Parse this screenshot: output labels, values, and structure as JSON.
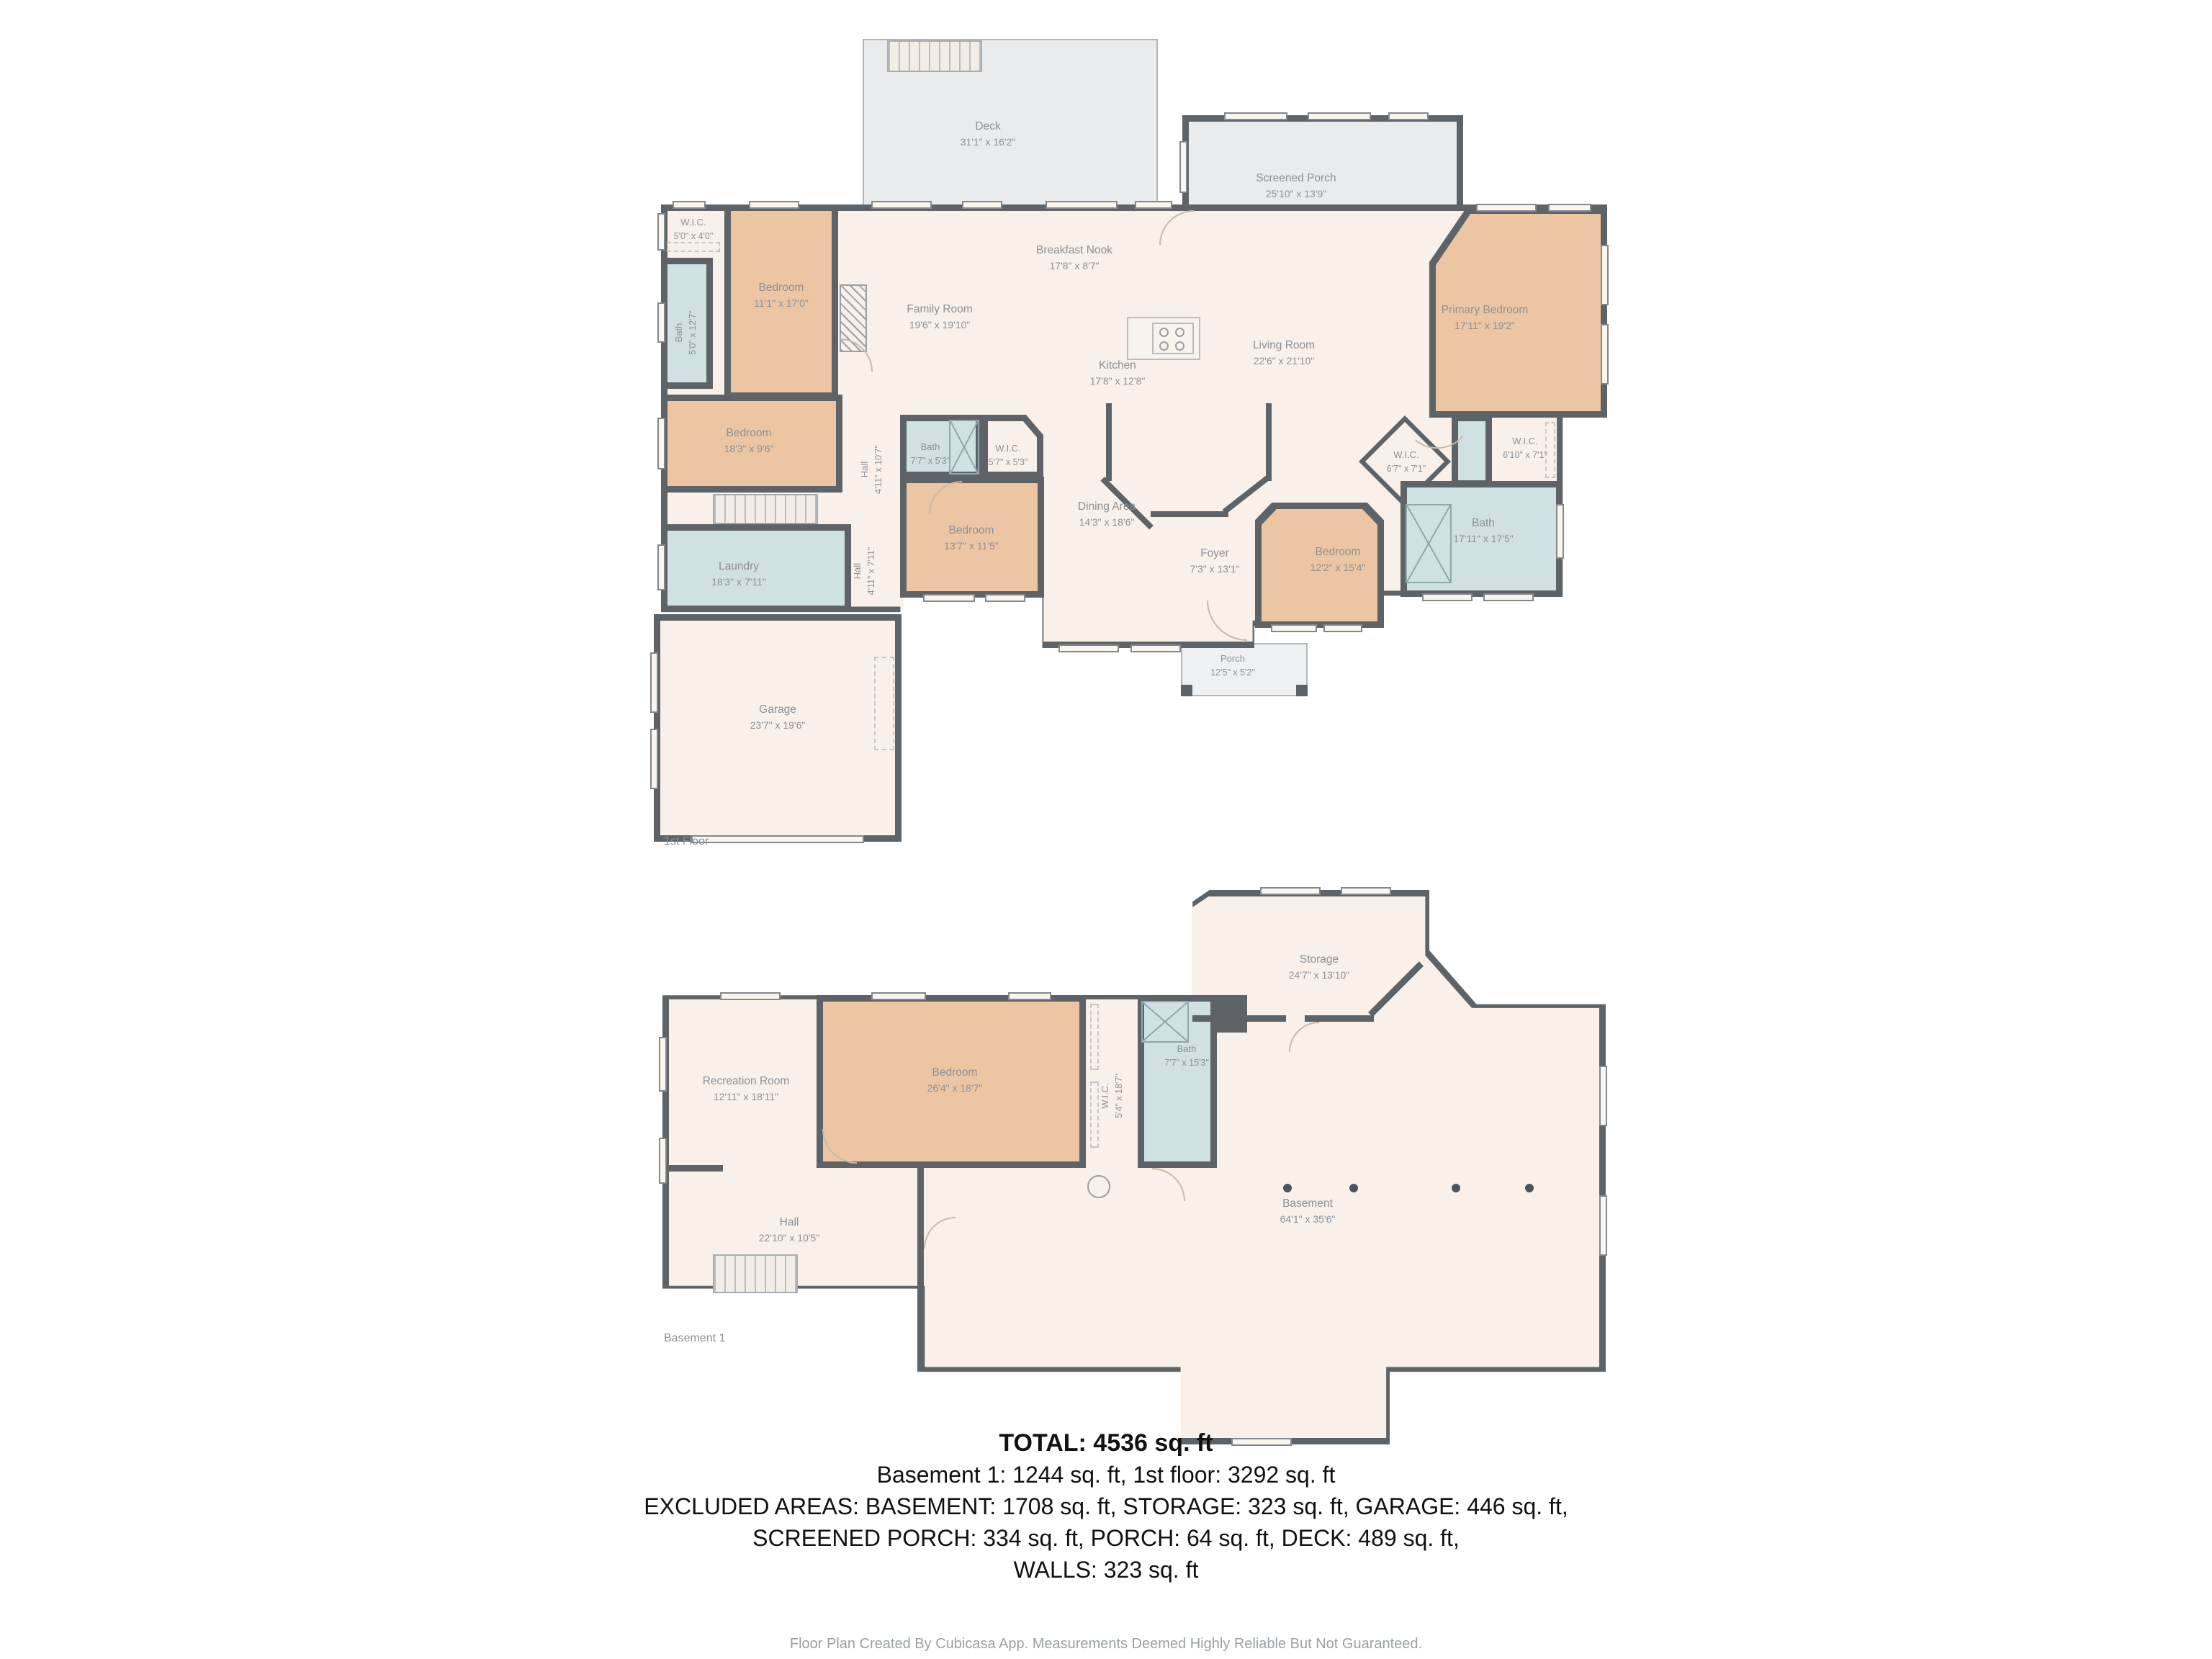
{
  "colors": {
    "wall": "#5d6367",
    "cream": "#f8f0e9",
    "tan": "#ecc5a2",
    "blue": "#cfe1e3",
    "deck_gray": "#e9ebec",
    "label_gray": "#8d9196"
  },
  "floor1": {
    "label": "1st Floor",
    "rooms": [
      {
        "name": "Deck",
        "dims": "31'1\" x 16'2\""
      },
      {
        "name": "Screened Porch",
        "dims": "25'10\" x 13'9\""
      },
      {
        "name": "W.I.C.",
        "dims": "5'0\" x 4'0\""
      },
      {
        "name": "Bedroom",
        "dims": "11'1\" x 17'0\""
      },
      {
        "name": "Bath",
        "dims": "5'0\" x 12'7\""
      },
      {
        "name": "Family Room",
        "dims": "19'6\" x 19'10\""
      },
      {
        "name": "Breakfast Nook",
        "dims": "17'8\" x 8'7\""
      },
      {
        "name": "Kitchen",
        "dims": "17'8\" x 12'8\""
      },
      {
        "name": "Living Room",
        "dims": "22'6\" x 21'10\""
      },
      {
        "name": "Primary Bedroom",
        "dims": "17'11\" x 19'2\""
      },
      {
        "name": "Bedroom",
        "dims": "18'3\" x 9'6\""
      },
      {
        "name": "Hall",
        "dims": "4'11\" x 10'7\""
      },
      {
        "name": "Bath",
        "dims": "7'7\" x 5'3\""
      },
      {
        "name": "W.I.C.",
        "dims": "5'7\" x 5'3\""
      },
      {
        "name": "W.I.C.",
        "dims": "6'7\" x 7'1\""
      },
      {
        "name": "W.I.C.",
        "dims": "6'10\" x 7'1\""
      },
      {
        "name": "Bath",
        "dims": "17'11\" x 17'5\""
      },
      {
        "name": "Bedroom",
        "dims": "13'7\" x 11'5\""
      },
      {
        "name": "Dining Area",
        "dims": "14'3\" x 18'6\""
      },
      {
        "name": "Bedroom",
        "dims": "12'2\" x 15'4\""
      },
      {
        "name": "Foyer",
        "dims": "7'3\" x 13'1\""
      },
      {
        "name": "Laundry",
        "dims": "18'3\" x 7'11\""
      },
      {
        "name": "Hall",
        "dims": "4'11\" x 7'11\""
      },
      {
        "name": "Garage",
        "dims": "23'7\" x 19'6\""
      },
      {
        "name": "Porch",
        "dims": "12'5\" x 5'2\""
      }
    ]
  },
  "basement": {
    "label": "Basement 1",
    "rooms": [
      {
        "name": "Storage",
        "dims": "24'7\" x 13'10\""
      },
      {
        "name": "Recreation Room",
        "dims": "12'11\" x 18'11\""
      },
      {
        "name": "Bedroom",
        "dims": "26'4\" x 18'7\""
      },
      {
        "name": "W.I.C.",
        "dims": "5'4\" x 18'7\""
      },
      {
        "name": "Bath",
        "dims": "7'7\" x 15'3\""
      },
      {
        "name": "Hall",
        "dims": "22'10\" x 10'5\""
      },
      {
        "name": "Basement",
        "dims": "64'1\" x 35'6\""
      }
    ]
  },
  "summary": {
    "total": "TOTAL: 4536 sq. ft",
    "line1": "Basement 1: 1244 sq. ft, 1st floor: 3292 sq. ft",
    "line2": "EXCLUDED AREAS: BASEMENT: 1708 sq. ft, STORAGE: 323 sq. ft, GARAGE: 446 sq. ft,",
    "line3": "SCREENED PORCH: 334 sq. ft, PORCH: 64 sq. ft, DECK: 489 sq. ft,",
    "line4": "WALLS: 323 sq. ft"
  },
  "footer": "Floor Plan Created By Cubicasa App. Measurements Deemed Highly Reliable But Not Guaranteed."
}
